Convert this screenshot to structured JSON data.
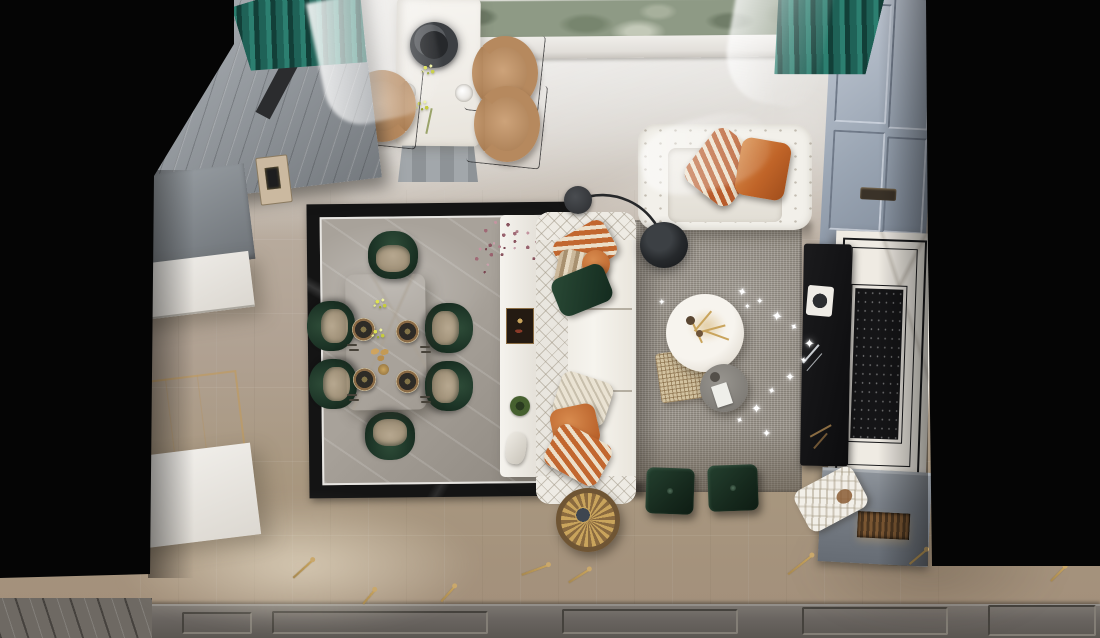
{
  "scene": {
    "description": "Top-down 3D architectural render of an open-plan living and dining room with kitchen island, marble dining set, tufted sofa, fireplace wall and teal window drapery",
    "view": "bird's-eye"
  },
  "icons": {
    "sparkle": "✦"
  },
  "palette": {
    "void": "#050505",
    "floorLight": "#d5d2cd",
    "floorBeige": "#b0a192",
    "floorDark": "#a3907b",
    "panelGray": "#696460",
    "inlayBlack": "#141414",
    "inlayMarble": "#a8a29a",
    "marbleWhite": "#f3f1ec",
    "teal": "#2c7f70",
    "tealDark": "#123f38",
    "cabBlue": "#9ba6b4",
    "cabGray": "#91969b",
    "counterWhite": "#eceae6",
    "tan": "#b6895e",
    "greenChair": "#2e4c38",
    "greenDark": "#122218",
    "seatTan": "#b6a78f",
    "orange": "#c2672f",
    "orangeLight": "#d88b4e",
    "stripeCream": "#ecdfc9",
    "greenPillow": "#1d3a2b",
    "knitCream": "#eae3d3",
    "rugGray": "#9d978e",
    "rugDark": "#6f675d",
    "lampBlack": "#26282a",
    "gold": "#c9a45c",
    "bronze": "#7c5e38",
    "cane": "#d2c2a0",
    "grayTable": "#8d8a85",
    "fireMarble": "#efebe3",
    "fireBlack": "#151517",
    "shelfGray": "#7e858d",
    "greenery": "#8e9a85",
    "sillWhite": "#f0eeea"
  },
  "objects": {
    "window": {
      "label": "Window with garden view"
    },
    "window_sill": {
      "label": "White window sill"
    },
    "curtain_teal": {
      "label": "Teal drapery"
    },
    "sheer": {
      "label": "Sheer curtain"
    },
    "wardrobe": {
      "label": "Tall gray paneled cabinet"
    },
    "intercom": {
      "label": "Wall control panel"
    },
    "upper_cabinet": {
      "label": "Gray kitchen cabinet"
    },
    "counter": {
      "label": "White counter"
    },
    "glass_console": {
      "label": "Glass console table"
    },
    "base_cabinet": {
      "label": "White base cabinet"
    },
    "island": {
      "label": "White breakfast table"
    },
    "pendant": {
      "label": "Black dome pendant lamp"
    },
    "island_chair": {
      "label": "Tan dining chair"
    },
    "island_plate": {
      "label": "White place setting"
    },
    "island_flowers": {
      "label": "Yellow flower stems"
    },
    "inlay": {
      "label": "Black-framed marble floor inlay"
    },
    "dining_table": {
      "label": "White marble dining table"
    },
    "dining_chair": {
      "label": "Green velvet dining chair"
    },
    "place_setting": {
      "label": "Dinner place setting"
    },
    "cutlery": {
      "label": "Cutlery"
    },
    "bread": {
      "label": "Pastry platter"
    },
    "dish_gold": {
      "label": "Small brass dish"
    },
    "sideboard": {
      "label": "White console sideboard"
    },
    "bouquet": {
      "label": "Dried mauve flower arrangement"
    },
    "art_tile": {
      "label": "Decorative tray"
    },
    "dish_green": {
      "label": "Green decor dish"
    },
    "figurine": {
      "label": "Porcelain figurine"
    },
    "sofa": {
      "label": "White tufted chesterfield sofa"
    },
    "pillow_striped": {
      "label": "Orange striped cushion"
    },
    "pillow_tan": {
      "label": "Tan striped cushion"
    },
    "pillow_orange": {
      "label": "Orange cushion"
    },
    "pillow_green": {
      "label": "Green velvet cushion"
    },
    "pillow_knit": {
      "label": "Cream knit cushion"
    },
    "floor_lamp": {
      "label": "Black arc floor lamp"
    },
    "rug": {
      "label": "Gray boucle area rug"
    },
    "coffee_table": {
      "label": "Round white marble coffee table"
    },
    "table_decor": {
      "label": "Gold dried botanicals"
    },
    "side_table_gray": {
      "label": "Round gray side table"
    },
    "cane_mat": {
      "label": "Woven cane mat"
    },
    "string_lights": {
      "label": "String lights"
    },
    "ottoman": {
      "label": "Green velvet ottoman"
    },
    "gold_table": {
      "label": "Brass fan side table"
    },
    "loveseat": {
      "label": "White tufted loveseat"
    },
    "fireplace": {
      "label": "Marble fireplace with black firebox"
    },
    "fp_console": {
      "label": "Black decor console"
    },
    "log_shelf": {
      "label": "Hearth shelf with firewood"
    },
    "blanket": {
      "label": "Knit throw blanket"
    },
    "right_cabinet": {
      "label": "Blue-gray paneled cabinet wall"
    },
    "paneling": {
      "label": "Gray wall paneling"
    },
    "sprig": {
      "label": "Gold sprig floor decoration"
    },
    "void": {
      "label": "Out-of-frame area"
    }
  }
}
